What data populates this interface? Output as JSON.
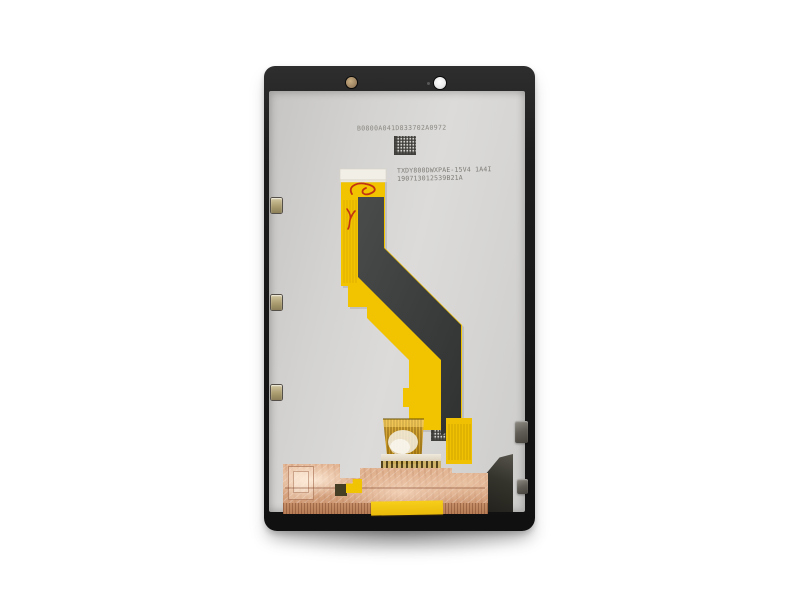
{
  "scene": {
    "description": "Product photo of a tablet LCD display assembly, rear side, on white background",
    "subject": "tablet-lcd-assembly-rear",
    "components": [
      "black outer frame",
      "gray panel back",
      "front camera hole",
      "light sensor hole",
      "yellow flex ribbon cable with dark stiffener",
      "red QC ink marks",
      "gold finger board connector",
      "copper shielding tape",
      "kapton tape strip",
      "edge gold contacts",
      "metal spring tabs",
      "datamatrix codes"
    ]
  },
  "printed_labels": {
    "serial": "B0800A041D833702A0972",
    "part_number_line1": "TXDY800DWXPAE-15V4 1A4I",
    "part_number_line2": "190713012539B21A"
  },
  "colors": {
    "background": "#ffffff",
    "frame_black": "#1c1c1c",
    "panel_gray": "#d6d5d3",
    "flex_yellow": "#f2c400",
    "stiffener_gray": "#3d3f3f",
    "copper_tape": "#dcab88",
    "qc_mark_red": "#c23312",
    "gold_connector": "#c89b30"
  }
}
